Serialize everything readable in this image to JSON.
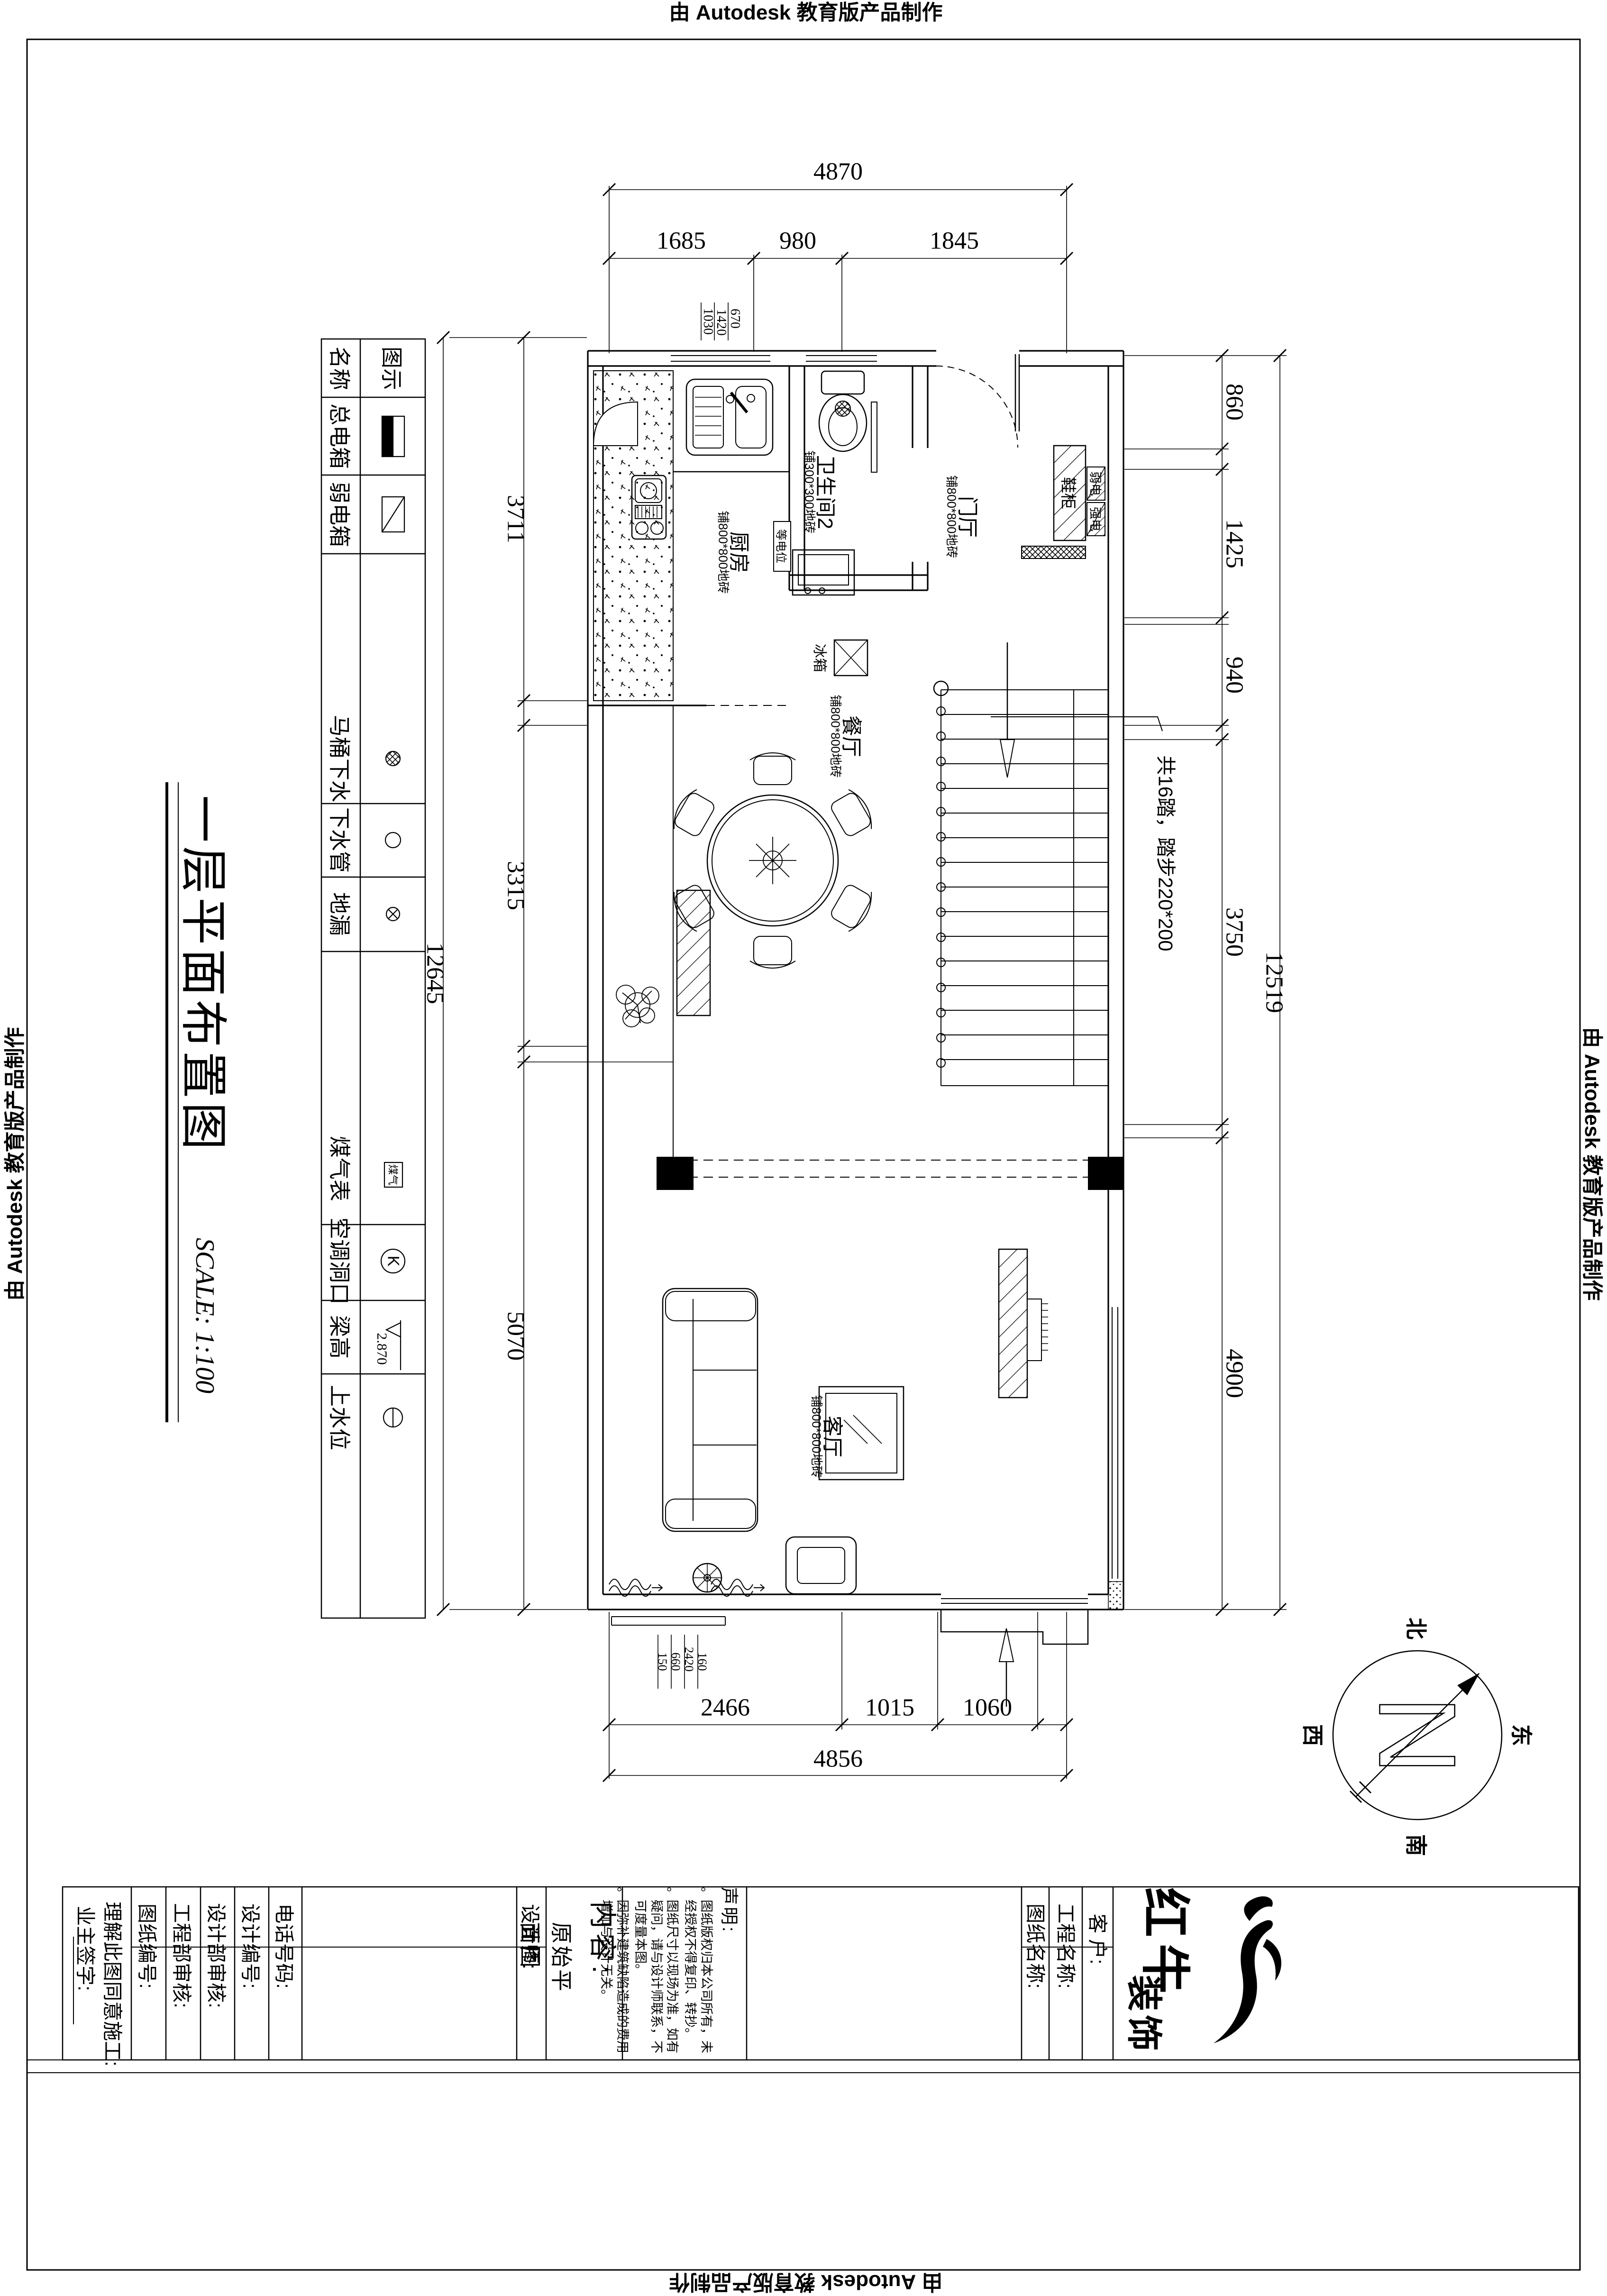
{
  "stamp": {
    "text": "由 Autodesk 教育版产品制作"
  },
  "title": {
    "name": "一层平面布置图",
    "scale": "SCALE: 1:100"
  },
  "legend": {
    "header": {
      "name_col": "名称",
      "symbol_col": "图示"
    },
    "items": [
      {
        "label": "总电箱"
      },
      {
        "label": "弱电箱"
      },
      {
        "label": "马桶下水"
      },
      {
        "label": "下水管"
      },
      {
        "label": "地漏"
      },
      {
        "label": "煤气表",
        "symbol_text": "煤气"
      },
      {
        "label": "空调洞口",
        "symbol_text": "K"
      },
      {
        "label": "梁高",
        "symbol_text": "2.870"
      },
      {
        "label": "上水位"
      }
    ]
  },
  "rooms": {
    "kitchen": {
      "name": "厨房",
      "floor": "铺800*800地砖"
    },
    "bath": {
      "name": "卫生间2",
      "floor": "铺300*300地砖"
    },
    "entry": {
      "name": "门厅",
      "floor": "铺800*800地砖"
    },
    "dining": {
      "name": "餐厅",
      "floor": "铺800*800地砖"
    },
    "living": {
      "name": "客厅",
      "floor": "铺800*800地砖"
    }
  },
  "plan_labels": {
    "shoe_cabinet": "鞋柜",
    "weak_power": "弱电",
    "strong_power": "强电",
    "equipotential": "等电位",
    "fridge": "冰箱",
    "stair_note": "共16踏，踏步220*200"
  },
  "dimensions": {
    "top": {
      "overall": "4870",
      "segments": [
        "1685",
        "980",
        "1845"
      ],
      "window_stack": [
        "1030",
        "1420",
        "670"
      ]
    },
    "left": {
      "segments": [
        "3711",
        "3315",
        "5070"
      ],
      "overall": "12645"
    },
    "right": {
      "segments": [
        "860",
        "1425",
        "940",
        "3750",
        "4900"
      ],
      "overall": "12519"
    },
    "bottom": {
      "segments": [
        "2466",
        "1015",
        "1060"
      ],
      "overall": "4856",
      "window_stack": [
        "150",
        "660",
        "2420",
        "160"
      ]
    }
  },
  "compass": {
    "n": "N",
    "north": "北",
    "east": "东",
    "south": "南",
    "west": "西"
  },
  "titleblock": {
    "owner_sign": "业主签字:",
    "agree": "理解此图同意施工:",
    "drawing_no": "图纸编号:",
    "eng_audit": "工程部审核:",
    "design_audit": "设计部审核:",
    "design_no": "设计编号:",
    "phone": "电话号码:",
    "designer": "设计师:",
    "content_label": "内容:",
    "content_value": "原始平面图",
    "statement_label": "声明:",
    "bullet_marker": "。",
    "statements": [
      "图纸版权归本公司所有，未经授权不得复印、转抄。",
      "图纸尺寸以现场为准，如有疑问，请与设计师联系，不可度量本图。",
      "因弥补建筑缺陷造成的费用增加与设计无关。"
    ],
    "drawing_name": "图纸名称:",
    "project_name": "工程名称:",
    "client": "客 户:",
    "brand_main": "红牛",
    "brand_sub": "装饰"
  }
}
